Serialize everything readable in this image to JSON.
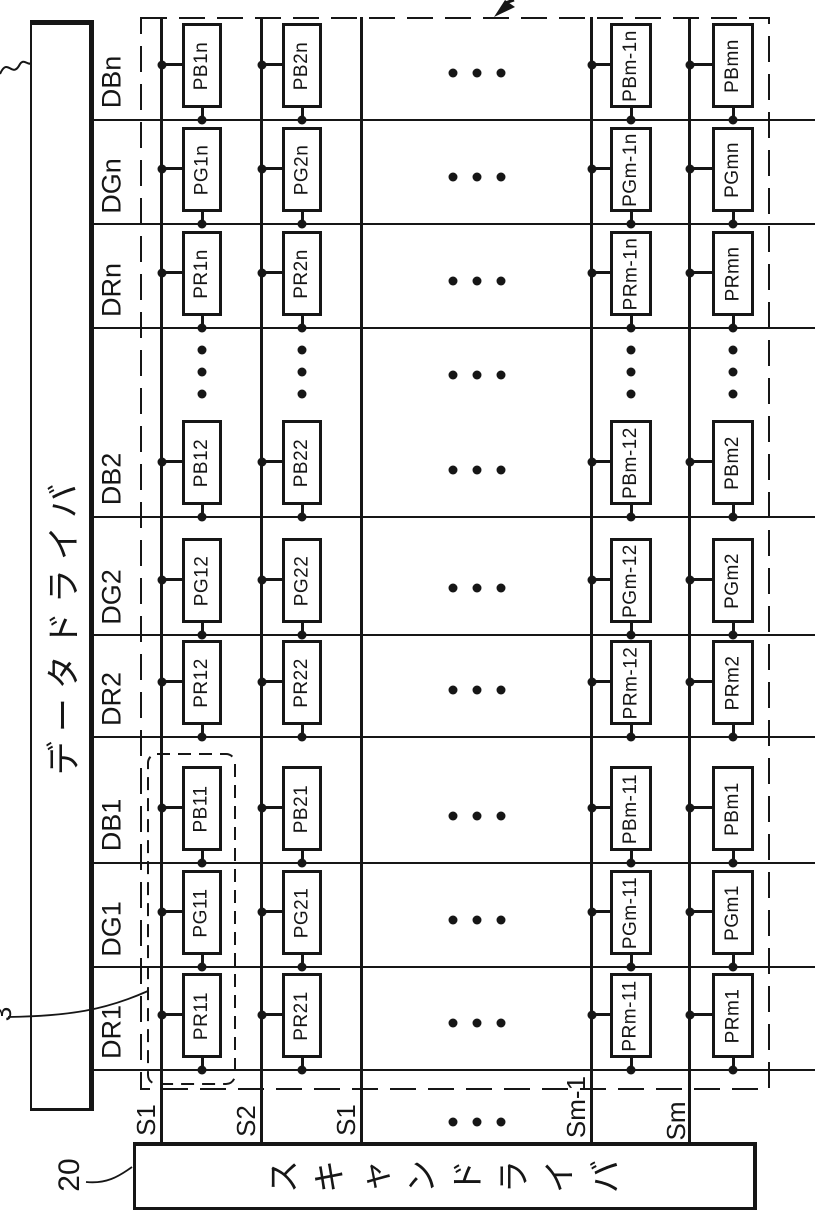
{
  "figure": {
    "colors": {
      "ink": "#161616",
      "paper": "#ffffff"
    },
    "data_driver": {
      "label": "データドライバ"
    },
    "scan_driver": {
      "label": "スキャンドライバ",
      "ref": "20"
    },
    "pixel_group_ref": "3",
    "row_labels": [
      "DBn",
      "DGn",
      "DRn",
      "DB2",
      "DG2",
      "DR2",
      "DB1",
      "DG1",
      "DR1"
    ],
    "columns": [
      {
        "scan_label": "S1",
        "cells": [
          "PB1n",
          "PG1n",
          "PR1n",
          "PB12",
          "PG12",
          "PR12",
          "PB11",
          "PG11",
          "PR11"
        ]
      },
      {
        "scan_label": "S2",
        "cells": [
          "PB2n",
          "PG2n",
          "PR2n",
          "PB22",
          "PG22",
          "PR22",
          "PB21",
          "PG21",
          "PR21"
        ]
      },
      {
        "scan_label": "S1",
        "cells": []
      },
      {
        "scan_label": "Sm-1",
        "cells": [
          "PBm-1n",
          "PGm-1n",
          "PRm-1n",
          "PBm-12",
          "PGm-12",
          "PRm-12",
          "PBm-11",
          "PGm-11",
          "PRm-11"
        ]
      },
      {
        "scan_label": "Sm",
        "cells": [
          "PBmn",
          "PGmn",
          "PRmn",
          "PBm2",
          "PGm2",
          "PRm2",
          "PBm1",
          "PGm1",
          "PRm1"
        ]
      }
    ]
  }
}
